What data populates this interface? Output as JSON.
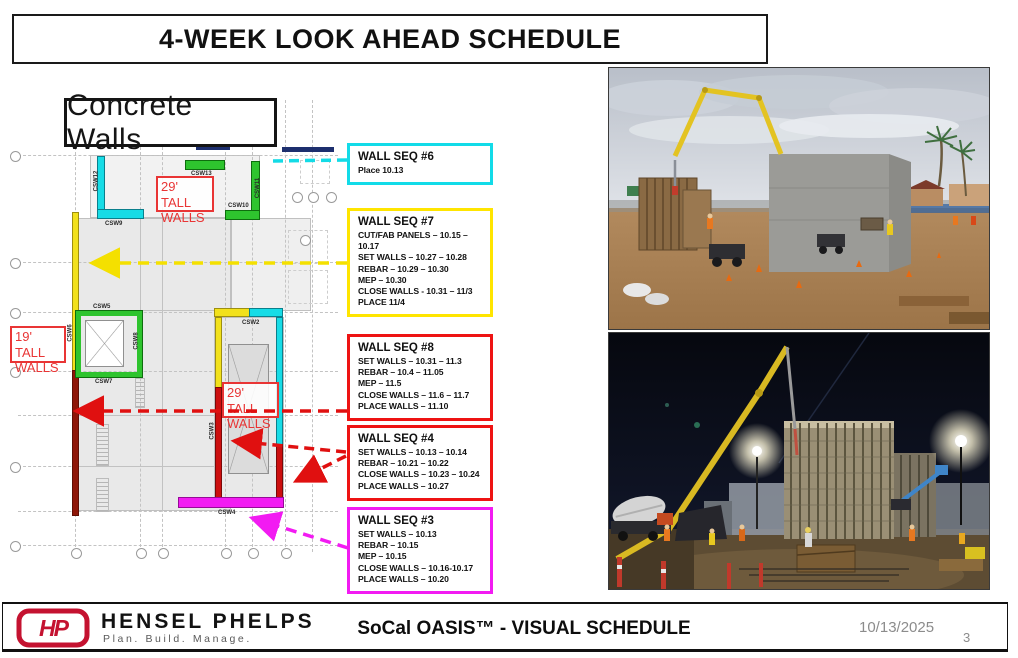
{
  "title": "4-WEEK LOOK AHEAD SCHEDULE",
  "plan": {
    "heading": "Concrete Walls",
    "labels": {
      "tall_29_top": "29' TALL WALLS",
      "tall_19_left": "19' TALL WALLS",
      "tall_29_mid": "29' TALL WALLS"
    },
    "wall_tags": {
      "csw2": "CSW2",
      "csw3": "CSW3",
      "csw4": "CSW4",
      "csw5": "CSW5",
      "csw6": "CSW6",
      "csw7": "CSW7",
      "csw8": "CSW8",
      "csw9": "CSW9",
      "csw10": "CSW10",
      "csw11": "CSW11",
      "csw12": "CSW12",
      "csw13": "CSW13"
    },
    "wall_colors": {
      "cyan": "#17dce6",
      "green": "#2ec42e",
      "yellow": "#f2e11c",
      "red": "#cc0f0f",
      "dark_red": "#8f1608",
      "magenta": "#f21bf2"
    }
  },
  "callouts": [
    {
      "title": "WALL SEQ #6",
      "color": "#12dbe8",
      "lines": [
        "Place 10.13"
      ]
    },
    {
      "title": "WALL SEQ #7",
      "color": "#ffe500",
      "lines": [
        "CUT/FAB PANELS – 10.15 – 10.17",
        "SET WALLS – 10.27 – 10.28",
        "REBAR – 10.29 – 10.30",
        "MEP – 10.30",
        "CLOSE WALLS - 10.31 – 11/3",
        "PLACE 11/4"
      ]
    },
    {
      "title": "WALL SEQ #8",
      "color": "#ee1313",
      "lines": [
        "SET WALLS – 10.31 – 11.3",
        "REBAR – 10.4 – 11.05",
        "MEP – 11.5",
        "CLOSE WALLS – 11.6 – 11.7",
        "PLACE WALLS – 11.10"
      ]
    },
    {
      "title": "WALL SEQ #4",
      "color": "#ee1313",
      "lines": [
        "SET WALLS – 10.13 – 10.14",
        "REBAR – 10.21 – 10.22",
        "CLOSE WALLS – 10.23 – 10.24",
        "PLACE WALLS – 10.27"
      ]
    },
    {
      "title": "WALL SEQ #3",
      "color": "#f21bf2",
      "lines": [
        "SET WALLS – 10.13",
        "REBAR – 10.15",
        "MEP – 10.15",
        "CLOSE WALLS – 10.16-10.17",
        "PLACE WALLS – 10.20"
      ]
    }
  ],
  "footer": {
    "logo_monogram": "HP",
    "brand": "HENSEL PHELPS",
    "tagline": "Plan. Build. Manage.",
    "center_title": "SoCal OASIS™ - VISUAL SCHEDULE",
    "date": "10/13/2025",
    "page_number": "3",
    "brand_red": "#c41230"
  }
}
